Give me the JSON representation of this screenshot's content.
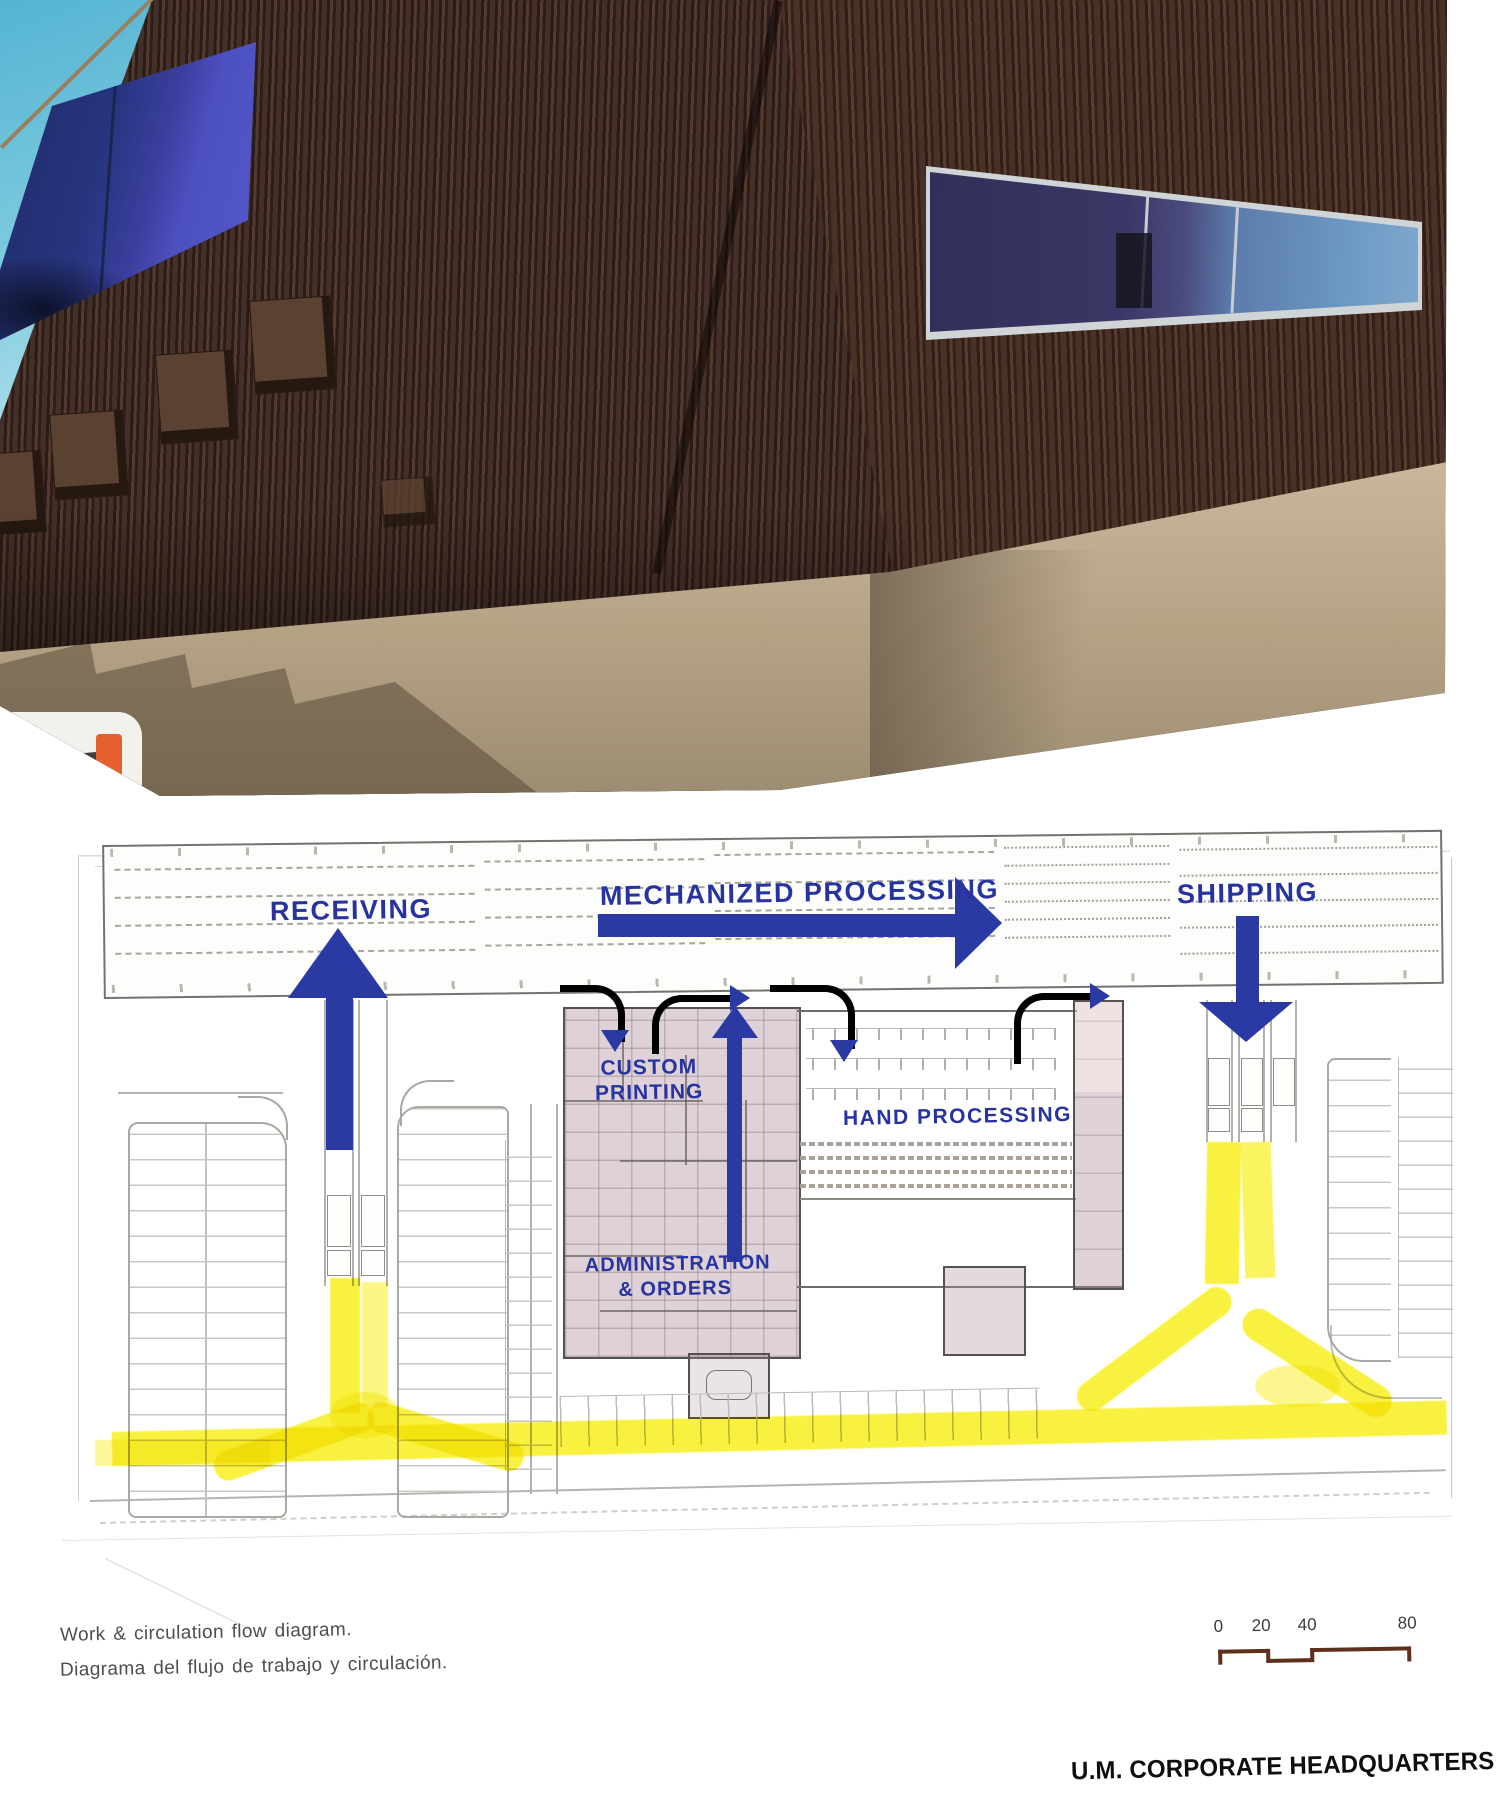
{
  "diagram": {
    "flow_labels": {
      "receiving": "RECEIVING",
      "mechanized_processing": "MECHANIZED PROCESSING",
      "shipping": "SHIPPING",
      "custom_printing": [
        "CUSTOM",
        "PRINTING"
      ],
      "hand_processing": "HAND PROCESSING",
      "administration": [
        "ADMINISTRATION",
        "& ORDERS"
      ]
    },
    "colors": {
      "flow_arrow_blue": "#2b3aa3",
      "circulation_yellow": "#f8ef1d",
      "office_tint_mauve": "#b092a0",
      "siding_brown": "#3a2721",
      "scale_bar_brown": "#5e2f1c"
    }
  },
  "captions": {
    "english": "Work & circulation flow diagram.",
    "spanish": "Diagrama del flujo de trabajo y circulación."
  },
  "scale_bar": {
    "ticks": [
      "0",
      "20",
      "40",
      "80"
    ]
  },
  "footer": {
    "project_title": "U.M. CORPORATE HEADQUARTERS"
  }
}
